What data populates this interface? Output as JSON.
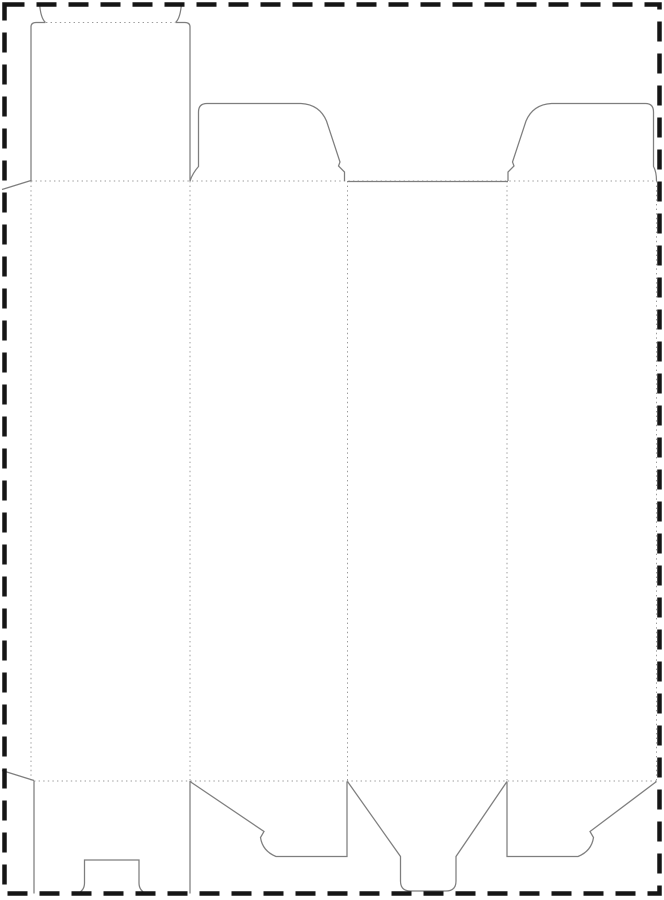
{
  "canvas": {
    "width": 664,
    "height": 900,
    "background": "#ffffff"
  },
  "page_border": {
    "name": "page-trim-dashed-border",
    "color": "#151515",
    "stroke_width": 4.5,
    "dash": "20 12",
    "x": 4.5,
    "y": 4.5,
    "width": 655,
    "height": 889
  },
  "dieline": {
    "cut_style": {
      "color": "#7e7e7e",
      "width": 1.25
    },
    "fold_style": {
      "color": "#9b9b9b",
      "width": 1,
      "dash": "1.4 3.2"
    },
    "cut_paths": [
      {
        "name": "glue-flap-top-bevel",
        "d": "M 2 189.5 L 31 180.5"
      },
      {
        "name": "glue-flap-bottom-bevel",
        "d": "M 2 770.5 L 34 780.5"
      },
      {
        "name": "lid-panel-left-edge",
        "d": "M 31 181 L 31 27 Q 31 22.5 36 22.5 L 45.5 22.5"
      },
      {
        "name": "tuck-flap-left-shoulder",
        "d": "M 45.5 22.5 C 41.5 19 40 11 39.5 2.5"
      },
      {
        "name": "lid-panel-right-edge",
        "d": "M 190 181 L 190 27 Q 190 22.5 185 22.5 L 175.5 22.5"
      },
      {
        "name": "tuck-flap-right-shoulder",
        "d": "M 175.5 22.5 C 179.5 19 181 11 181.5 2.5"
      },
      {
        "name": "top-dust-flap-front-outline",
        "d": "M 190 181 C 192 175 194.5 171 198.5 166.5 L 198.5 112 Q 198.5 103.5 207 103.5 L 301 103.5 Q 319.5 104.5 326.5 121 L 340 162 L 338.5 166 L 344.5 172 L 344.5 181"
      },
      {
        "name": "panel3-top-cut-edge",
        "d": "M 347.5 181.5 L 508 181.5"
      },
      {
        "name": "top-dust-flap-back-outline",
        "d": "M 508 181 L 508 172 L 514 166 L 512.5 162 L 526 121 Q 533 104.5 551.5 103.5 L 645.5 103.5 Q 653.5 103.5 653.5 112 L 653.5 166.5 C 655.5 170 656.5 175.5 656.5 181"
      },
      {
        "name": "bottom-flap-side-left-edge",
        "d": "M 34 781 L 34 893.5"
      },
      {
        "name": "bottom-flap-side-right-edge",
        "d": "M 190 781 L 190 893.5"
      },
      {
        "name": "bottom-flap-lock-notch",
        "d": "M 78 893.5 Q 84.5 890 84.5 883 L 84.5 860 L 139 860 L 139 883 Q 139 890 145.5 893.5"
      },
      {
        "name": "bottom-flap-front-outline",
        "d": "M 190 781.5 L 264 831.5 L 260.5 837.5 Q 262.5 851 276 856.5 L 347 856.5 L 347 781.5"
      },
      {
        "name": "bottom-tuck-tab-outline",
        "d": "M 347.5 781.5 L 400.5 856.5 L 400.5 881 Q 400.5 891 410.5 891 L 446 891 Q 456 891 456 881 L 456 856.5 L 507 781.5"
      },
      {
        "name": "bottom-flap-back-outline",
        "d": "M 507 781.5 L 507 856.5 L 578 856.5 Q 591.5 851 593.5 837.5 L 590 831.5 L 656.5 781.5"
      }
    ],
    "fold_paths": [
      {
        "name": "tuck-flap-fold",
        "d": "M 46 22.5 L 175 22.5"
      },
      {
        "name": "top-horizontal-fold",
        "d": "M 31 181 L 656.5 181"
      },
      {
        "name": "bottom-horizontal-fold",
        "d": "M 34 781 L 656.5 781"
      },
      {
        "name": "glue-flap-fold",
        "d": "M 31 181 L 31 781"
      },
      {
        "name": "panel1-panel2-fold",
        "d": "M 190 181 L 190 781"
      },
      {
        "name": "panel2-panel3-fold",
        "d": "M 347.5 181 L 347.5 781"
      },
      {
        "name": "panel3-panel4-fold",
        "d": "M 507 181 L 507 781"
      },
      {
        "name": "panel4-right-fold",
        "d": "M 656.5 181 L 656.5 781"
      }
    ]
  }
}
